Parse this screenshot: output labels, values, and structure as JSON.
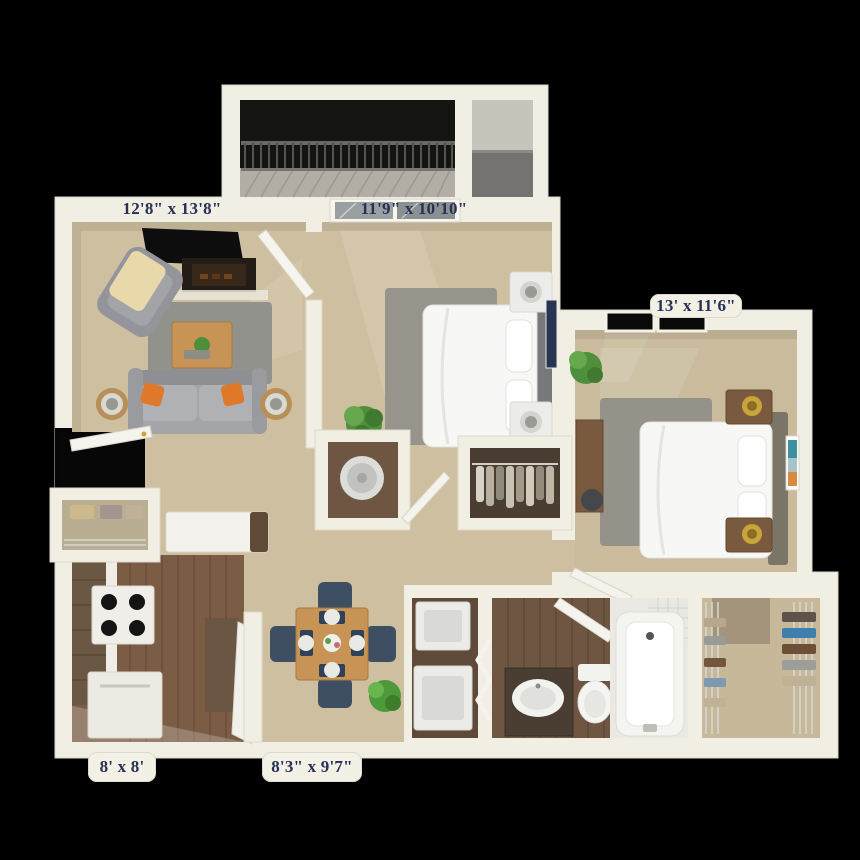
{
  "floor_plan": {
    "type": "3D apartment floor plan",
    "background_color": "#000000",
    "label_text_color": "#273055",
    "label_tab_color": "#f3f0e5",
    "wall_color": "#f1eee4",
    "carpet_color": "#cdbf9f",
    "wood_floor_color": "#7b5d46",
    "rooms": [
      {
        "id": "living-room",
        "dimensions": "12'8\" x 13'8\""
      },
      {
        "id": "bedroom-1",
        "dimensions": "11'9\" x 10'10\""
      },
      {
        "id": "bedroom-2",
        "dimensions": "13' x 11'6\""
      },
      {
        "id": "kitchen",
        "dimensions": "8' x 8'"
      },
      {
        "id": "dining-room",
        "dimensions": "8'3\" x 9'7\""
      },
      {
        "id": "balcony"
      },
      {
        "id": "storage-room"
      },
      {
        "id": "hallway"
      },
      {
        "id": "laundry-closet"
      },
      {
        "id": "bathroom"
      },
      {
        "id": "walk-in-closet"
      },
      {
        "id": "water-heater-closet"
      },
      {
        "id": "coat-closet"
      }
    ]
  }
}
